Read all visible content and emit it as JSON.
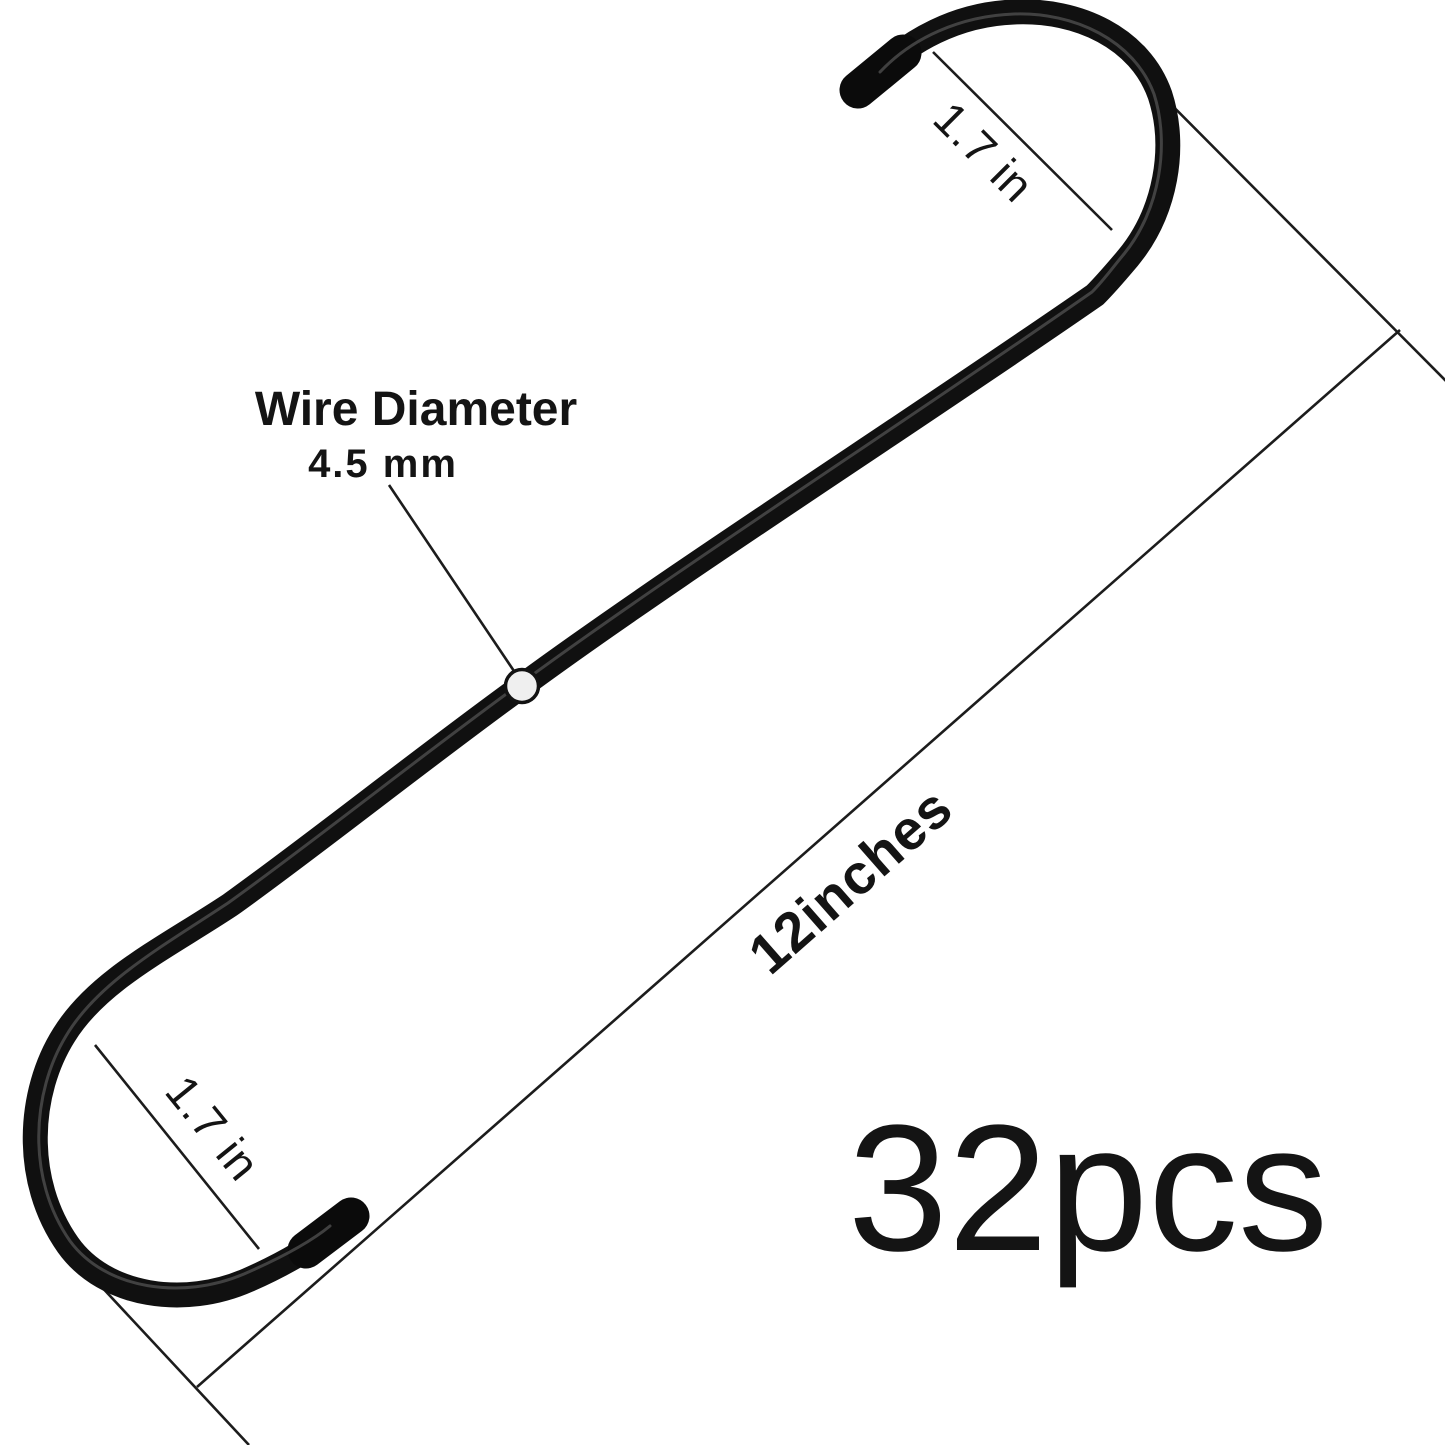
{
  "diagram": {
    "description": "Black S-shaped metal hanging hook with dimension callouts",
    "background_color": "#ffffff",
    "wire_color": "#101010",
    "annotation_line_color": "#1c1c1c",
    "marker_dot_fill": "#efefef",
    "labels": {
      "wire_diameter_title": "Wire Diameter",
      "wire_diameter_value": "4.5 mm",
      "top_hook_width": "1.7 in",
      "bottom_hook_width": "1.7 in",
      "overall_length": "12inches",
      "quantity": "32pcs"
    }
  }
}
